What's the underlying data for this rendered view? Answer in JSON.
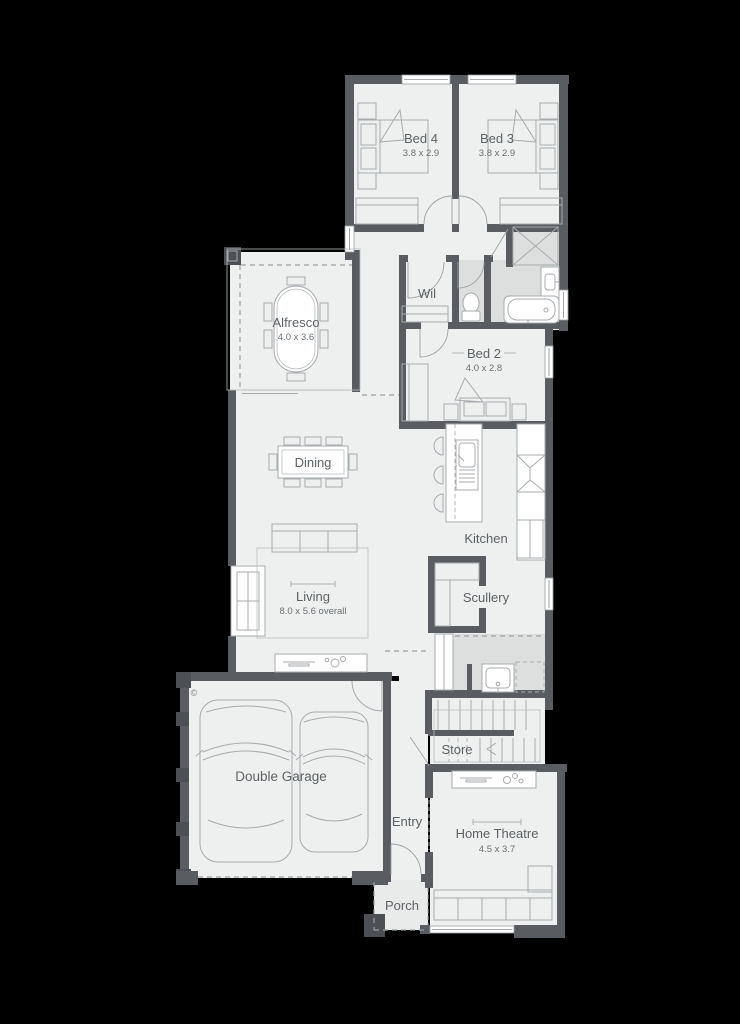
{
  "plan": {
    "rooms": {
      "bed4": {
        "label": "Bed 4",
        "dims": "3.8 x 2.9"
      },
      "bed3": {
        "label": "Bed 3",
        "dims": "3.8 x 2.9"
      },
      "wil": {
        "label": "Wil"
      },
      "alfresco": {
        "label": "Alfresco",
        "dims": "4.0 x 3.6"
      },
      "bed2": {
        "label": "Bed 2",
        "dims": "4.0 x 2.8"
      },
      "dining": {
        "label": "Dining"
      },
      "kitchen": {
        "label": "Kitchen"
      },
      "living": {
        "label": "Living",
        "dims": "8.0 x 5.6 overall"
      },
      "scullery": {
        "label": "Scullery"
      },
      "store": {
        "label": "Store"
      },
      "entry": {
        "label": "Entry"
      },
      "home_theatre": {
        "label": "Home Theatre",
        "dims": "4.5 x 3.7"
      },
      "double_garage": {
        "label": "Double Garage"
      },
      "porch": {
        "label": "Porch"
      }
    },
    "copyright_symbol": "©",
    "colors": {
      "background": "#000000",
      "wall": "#595d61",
      "floor": "#eef0ef",
      "wet_area": "#dcdfde",
      "furniture_line": "#a7abae",
      "label_text": "#5d6266"
    }
  }
}
